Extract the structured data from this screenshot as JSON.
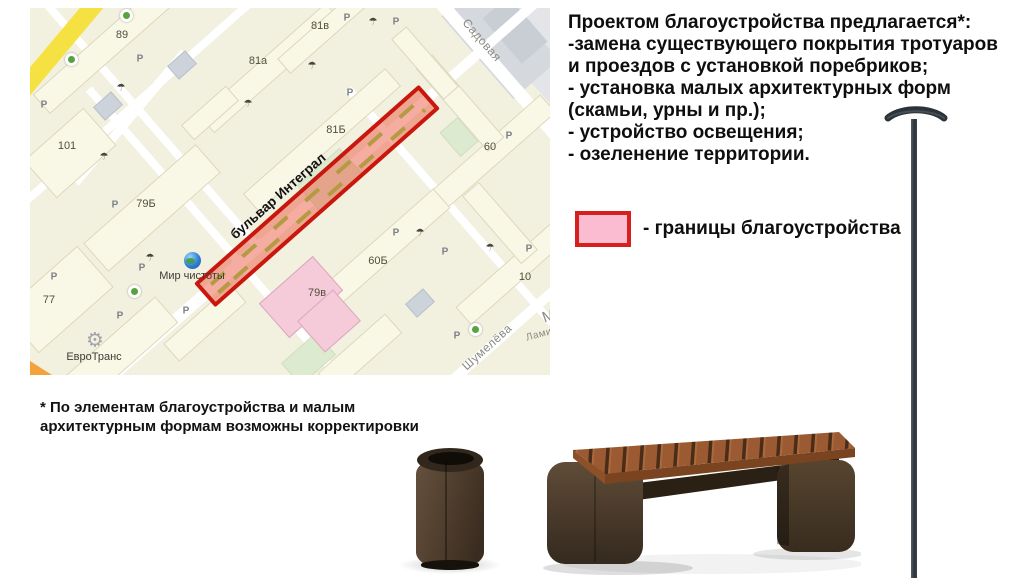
{
  "proposal": {
    "lines": [
      "Проектом благоустройства предлагается*:",
      "-замена существующего покрытия тротуаров",
      "и проездов с установкой поребриков;",
      "- установка малых архитектурных форм",
      "(скамьи, урны и пр.);",
      "- устройство освещения;",
      "- озеленение территории."
    ]
  },
  "legend": {
    "label": "- границы благоустройства",
    "box_fill": "#fbbcd1",
    "box_border": "#d6201c"
  },
  "footnote": {
    "lines": [
      "* По элементам благоустройства и малым",
      "архитектурным формам возможны корректировки"
    ]
  },
  "map": {
    "highlight_fill": "rgba(235,105,82,0.55)",
    "highlight_border": "#c9170e",
    "parking_letter": "Р",
    "playground_glyph": "☂",
    "gear_glyph": "⚙",
    "labels": [
      {
        "text": "89"
      },
      {
        "text": "81а"
      },
      {
        "text": "81в"
      },
      {
        "text": "81Б"
      },
      {
        "text": "101"
      },
      {
        "text": "79Б"
      },
      {
        "text": "77"
      },
      {
        "text": "60"
      },
      {
        "text": "60Б"
      },
      {
        "text": "79в"
      },
      {
        "text": "10"
      },
      {
        "text": "Садовая"
      },
      {
        "text": "бульвар Интеграл"
      },
      {
        "text": "Шумелёва"
      },
      {
        "text": "Ламин"
      },
      {
        "text": "М"
      },
      {
        "text": "Мир чистоты"
      },
      {
        "text": "ЕвроТранс"
      }
    ]
  },
  "objects": {
    "bin": "urna-render",
    "bench": "bench-render",
    "lamp": "lamp-post-render"
  }
}
